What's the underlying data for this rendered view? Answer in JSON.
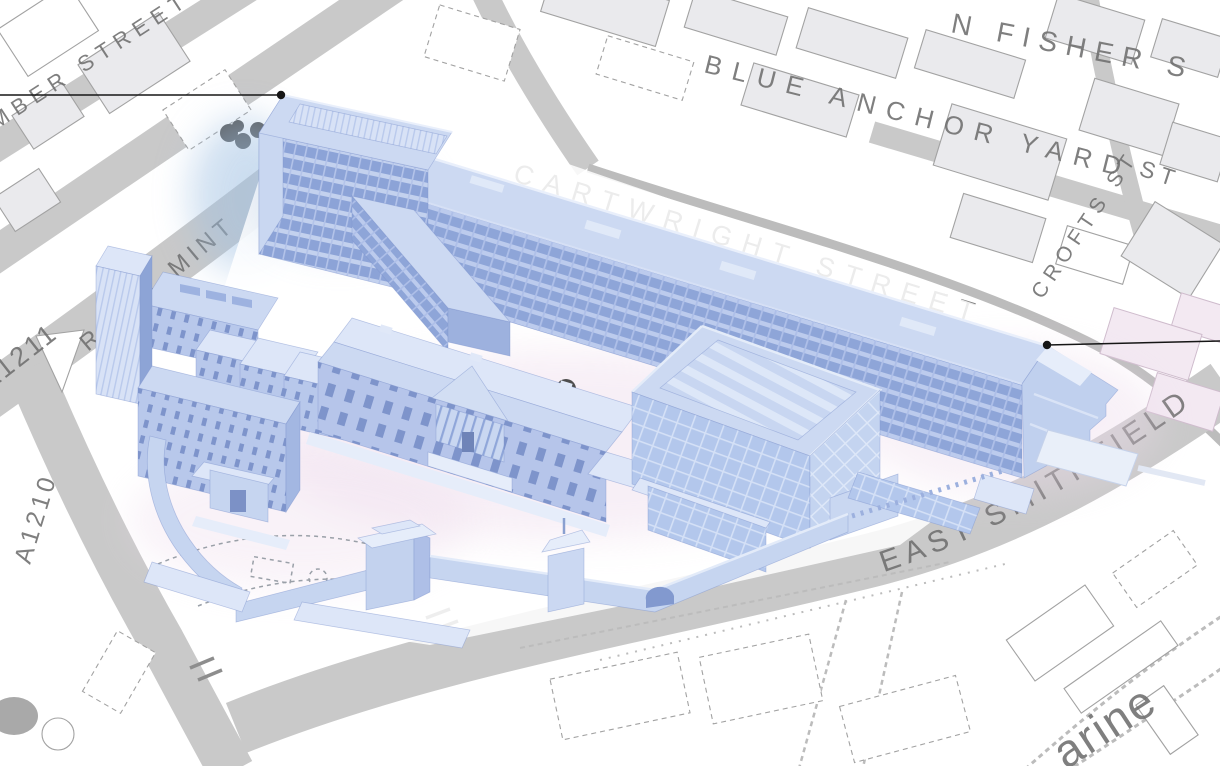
{
  "canvas": {
    "width": 1220,
    "height": 766
  },
  "map": {
    "street_labels": [
      {
        "id": "chamber-street-partial",
        "text": "MBER STREET"
      },
      {
        "id": "blue-anchor-yard",
        "text": "BLUE ANCHOR YARD"
      },
      {
        "id": "st-fragment",
        "text": "ST"
      },
      {
        "id": "john-fisher-street-partial",
        "text": "N FISHER S"
      },
      {
        "id": "crofts-street",
        "text": "CROFTS ST"
      },
      {
        "id": "cartwright-street",
        "text": "CARTWRIGHT STREET"
      },
      {
        "id": "royal-mint",
        "text": "ROYAL MINT"
      },
      {
        "id": "a1211",
        "text": "A1211"
      },
      {
        "id": "a1210",
        "text": "A1210"
      },
      {
        "id": "east-smithfield",
        "text": "EAST SMITHFIELD"
      },
      {
        "id": "katharine-partial",
        "text": "arine"
      }
    ]
  },
  "colors": {
    "page-bg": "#ffffff",
    "road": "#c9c9c9",
    "road-line": "#bcbcbc",
    "footprint-fill": "#eaeaed",
    "footprint-stroke": "#a2a2a2",
    "footprint-pink": "#f3e9f2",
    "label": "#6e6e6e",
    "leader": "#161616",
    "roof": "#ccd9f2",
    "roof-light": "#dde6f8",
    "facade": "#b4c5ea",
    "window": "#8ea5d8",
    "glass": "#b7cbec",
    "wall": "#c6d5f0",
    "deep": "#8095cc",
    "highlight": "#e6edfa",
    "shadow-blue": "#9fc0e2",
    "glow-pink": "#eedcec",
    "tree": "#585858"
  }
}
